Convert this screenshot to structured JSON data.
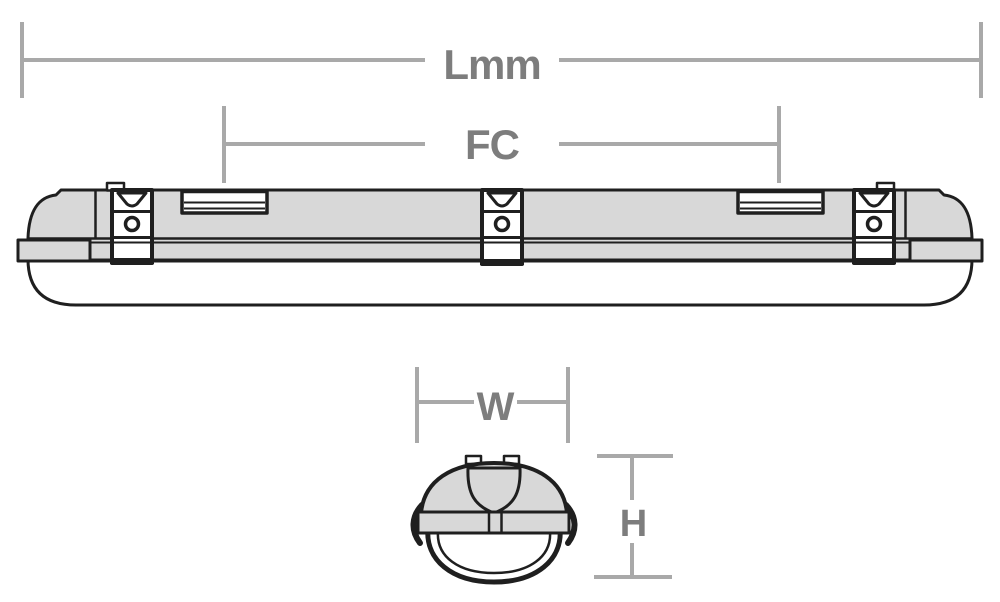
{
  "diagram": {
    "type": "luminaire-dimension-drawing",
    "dimensions": {
      "length": {
        "label": "Lmm"
      },
      "fixing_centres": {
        "label": "FC"
      },
      "width": {
        "label": "W"
      },
      "height": {
        "label": "H"
      }
    },
    "colors": {
      "background": "#ffffff",
      "outline": "#1f1f1f",
      "body_fill": "#d8d8d8",
      "diffuser_fill": "#ffffff",
      "dimension_line": "#a9a9a9",
      "dimension_text": "#7d7d7d"
    }
  }
}
